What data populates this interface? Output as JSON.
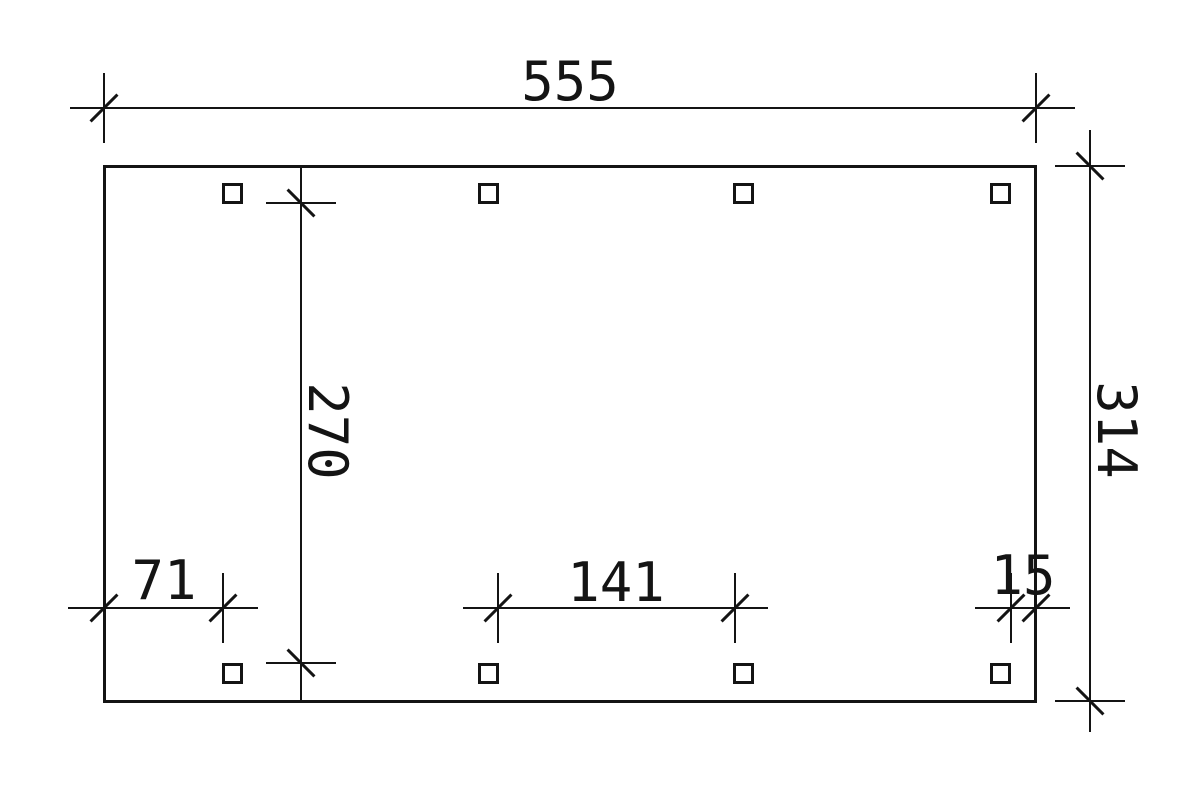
{
  "drawing": {
    "type": "technical-plan",
    "dim_labels": {
      "total_width": "555",
      "total_depth": "314",
      "inner_clear_depth": "270",
      "left_post_offset": "71",
      "post_clear_spacing": "141",
      "right_post_offset": "15"
    },
    "colors": {
      "line": "#141414",
      "background": "#ffffff"
    }
  }
}
